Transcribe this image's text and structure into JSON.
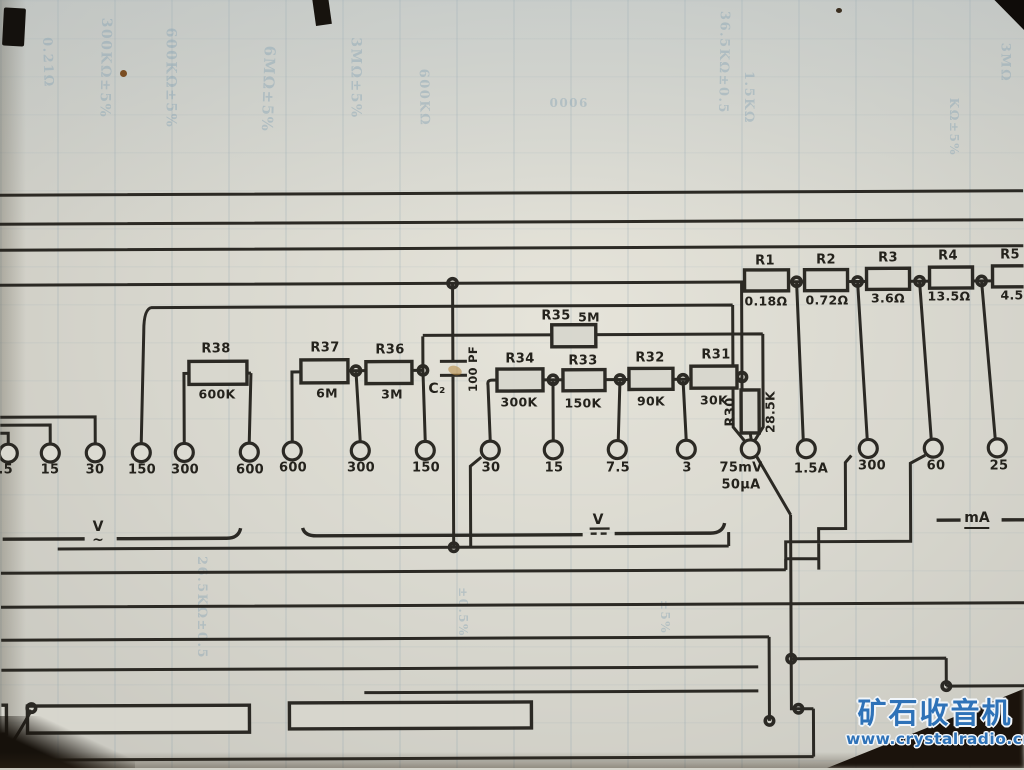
{
  "watermark": {
    "brand": "矿石收音机",
    "url": "www.crystalradio.cn"
  },
  "shunts": [
    {
      "ref": "R1",
      "value": "0.18Ω"
    },
    {
      "ref": "R2",
      "value": "0.72Ω"
    },
    {
      "ref": "R3",
      "value": "3.6Ω"
    },
    {
      "ref": "R4",
      "value": "13.5Ω"
    },
    {
      "ref": "R5",
      "value": "4.5"
    }
  ],
  "multipliers": [
    {
      "ref": "R38",
      "value": "600K"
    },
    {
      "ref": "R37",
      "value": "6M"
    },
    {
      "ref": "R36",
      "value": "3M"
    }
  ],
  "r35": {
    "ref": "R35",
    "value": "5M"
  },
  "dc_chain": [
    {
      "ref": "R34",
      "value": "300K"
    },
    {
      "ref": "R33",
      "value": "150K"
    },
    {
      "ref": "R32",
      "value": "90K"
    },
    {
      "ref": "R31",
      "value": "30K"
    }
  ],
  "r30": {
    "ref": "R30",
    "value": "28.5K"
  },
  "c2": {
    "ref": "C₂",
    "value": "100 PF"
  },
  "terminals": {
    "ac_volts": [
      "7.5",
      "15",
      "30",
      "150",
      "300",
      "600"
    ],
    "dc_volts": [
      "600",
      "300",
      "150",
      "30",
      "15",
      "7.5",
      "3"
    ],
    "meter": {
      "line1": "75mV",
      "line2": "50µA"
    },
    "current": [
      "1.5A",
      "300",
      "60",
      "25"
    ]
  },
  "sections": {
    "ac_label": "V",
    "ac_mark": "~",
    "dc_label": "V",
    "ma_label": "mA"
  },
  "bleedthrough": [
    "0.21Ω",
    "300KΩ±5%",
    "600KΩ±5%",
    "6MΩ±5%",
    "3MΩ±5%",
    "600KΩ",
    "36.5KΩ±0.5",
    "1.5KΩ",
    "3MΩ",
    "26.5KΩ±0.5",
    "±0.5%",
    "9000",
    "KΩ±5%",
    "±5%"
  ]
}
